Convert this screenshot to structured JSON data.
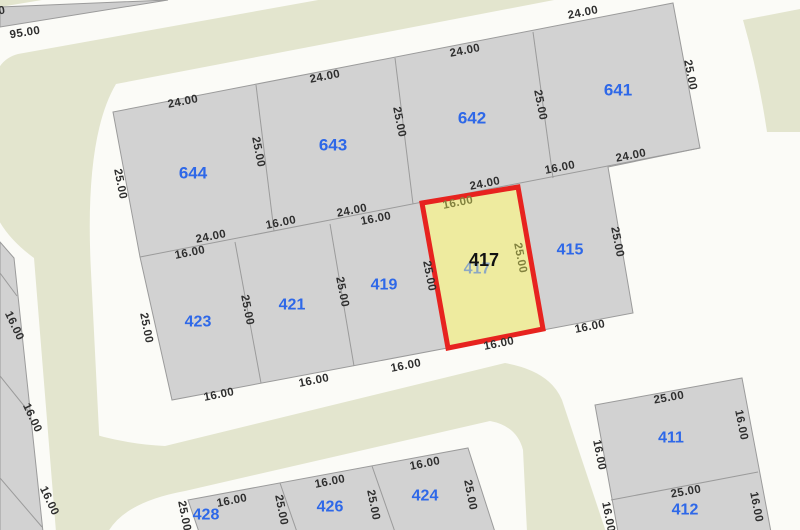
{
  "map": {
    "title": "cadastral-parcel-map",
    "canvas": {
      "width": 800,
      "height": 530
    },
    "colors": {
      "background": "#fbfbf7",
      "road": "#e3e5ce",
      "parcel_fill": "#d2d2d2",
      "wedge_fill": "#cdcdcd",
      "parcel_stroke": "#9b9b9b",
      "highlight_fill": "#eeeb9f",
      "highlight_stroke": "#e7231f",
      "parcel_number_blue": "#2e68e8",
      "dimension_text": "#2f2f2f",
      "dimension_on_highlight": "#82823e"
    },
    "roads": [
      {
        "name": "road-top-and-left",
        "d": "M 585,-48 L 18,54 Q -12,62 -6,108 L -6,210 Q 4,236 34,258 L 56,532 L 104,532 L 91,272 Q 84,138 116,84 L 575,-4 Z"
      },
      {
        "name": "road-bottom-l",
        "d": "M 80,430 Q 122,444 165,446 L 505,363 Q 550,371 562,400 L 606,532 L 527,532 L 523,450 Q 517,426 490,421 L 185,491 Q 125,502 108,532 L 80,532 Z"
      },
      {
        "name": "road-top-right",
        "d": "M 743,20 Q 758,72 767,132 L 800,132 L 800,9 Z"
      },
      {
        "name": "road-top-left-sliver",
        "d": "M 0,0 L 42,0 L 0,7 Z"
      }
    ],
    "blocks": [
      {
        "name": "block-main",
        "points": "113,112 673,3 700,148 608,167 633,313 172,400 140,257"
      },
      {
        "name": "block-south-west",
        "points": "188,500 468,448 495,532 199,532"
      },
      {
        "name": "block-south-east",
        "points": "595,405 742,378 771,532 618,532"
      },
      {
        "name": "block-west-strip",
        "points": "0,242 14,258 43,532 0,532"
      },
      {
        "name": "block-north-west-wedge",
        "points": "0,7 168,0 0,27",
        "wedge": true
      }
    ],
    "boundaries": [
      [
        140,
        257,
        700,
        148
      ],
      [
        256,
        85,
        274,
        231
      ],
      [
        395,
        58,
        413,
        204
      ],
      [
        533,
        32,
        553,
        178
      ],
      [
        235,
        242,
        261,
        383
      ],
      [
        330,
        224,
        354,
        366
      ],
      [
        280,
        483,
        297,
        532
      ],
      [
        372,
        466,
        395,
        532
      ],
      [
        611,
        500,
        758,
        472
      ],
      [
        0,
        273,
        17,
        296
      ],
      [
        0,
        376,
        29,
        412
      ],
      [
        0,
        478,
        42,
        527
      ]
    ],
    "parcels": [
      {
        "id": "644",
        "x": 193,
        "y": 173,
        "big": true
      },
      {
        "id": "643",
        "x": 333,
        "y": 145,
        "big": true
      },
      {
        "id": "642",
        "x": 472,
        "y": 118,
        "big": true
      },
      {
        "id": "641",
        "x": 618,
        "y": 90,
        "big": true
      },
      {
        "id": "423",
        "x": 198,
        "y": 322
      },
      {
        "id": "421",
        "x": 292,
        "y": 305
      },
      {
        "id": "419",
        "x": 384,
        "y": 285
      },
      {
        "id": "415",
        "x": 570,
        "y": 250
      },
      {
        "id": "411",
        "x": 671,
        "y": 438
      },
      {
        "id": "412",
        "x": 685,
        "y": 510
      },
      {
        "id": "424",
        "x": 425,
        "y": 496
      },
      {
        "id": "426",
        "x": 330,
        "y": 507
      },
      {
        "id": "428",
        "x": 206,
        "y": 515
      }
    ],
    "selected_parcel": {
      "id": "417",
      "points": "422,203 518,187 543,329 448,348",
      "label": {
        "x": 484,
        "y": 260
      },
      "ghost": {
        "x": 477,
        "y": 269
      }
    },
    "dimensions": [
      {
        "t": "24.00",
        "x": 183,
        "y": 102,
        "r": -11
      },
      {
        "t": "24.00",
        "x": 325,
        "y": 77,
        "r": -11
      },
      {
        "t": "24.00",
        "x": 465,
        "y": 51,
        "r": -11
      },
      {
        "t": "24.00",
        "x": 583,
        "y": 13,
        "r": -11
      },
      {
        "t": "25.00",
        "x": 120,
        "y": 184,
        "r": 79
      },
      {
        "t": "25.00",
        "x": 258,
        "y": 152,
        "r": 79
      },
      {
        "t": "25.00",
        "x": 399,
        "y": 122,
        "r": 79
      },
      {
        "t": "25.00",
        "x": 540,
        "y": 105,
        "r": 79
      },
      {
        "t": "25.00",
        "x": 690,
        "y": 75,
        "r": 79
      },
      {
        "t": "24.00",
        "x": 211,
        "y": 237,
        "r": -11
      },
      {
        "t": "16.00",
        "x": 190,
        "y": 253,
        "r": -11
      },
      {
        "t": "16.00",
        "x": 281,
        "y": 223,
        "r": -11
      },
      {
        "t": "24.00",
        "x": 352,
        "y": 211,
        "r": -11
      },
      {
        "t": "16.00",
        "x": 376,
        "y": 219,
        "r": -11
      },
      {
        "t": "24.00",
        "x": 485,
        "y": 184,
        "r": -11
      },
      {
        "t": "16.00",
        "x": 458,
        "y": 203,
        "r": -11,
        "olive": true
      },
      {
        "t": "16.00",
        "x": 560,
        "y": 168,
        "r": -11
      },
      {
        "t": "24.00",
        "x": 631,
        "y": 156,
        "r": -11
      },
      {
        "t": "25.00",
        "x": 146,
        "y": 328,
        "r": 79
      },
      {
        "t": "25.00",
        "x": 247,
        "y": 310,
        "r": 79
      },
      {
        "t": "25.00",
        "x": 342,
        "y": 292,
        "r": 79
      },
      {
        "t": "25.00",
        "x": 429,
        "y": 276,
        "r": 79
      },
      {
        "t": "25.00",
        "x": 520,
        "y": 258,
        "r": 79,
        "olive": true
      },
      {
        "t": "25.00",
        "x": 617,
        "y": 242,
        "r": 79
      },
      {
        "t": "16.00",
        "x": 219,
        "y": 395,
        "r": -11
      },
      {
        "t": "16.00",
        "x": 314,
        "y": 381,
        "r": -11
      },
      {
        "t": "16.00",
        "x": 406,
        "y": 366,
        "r": -11
      },
      {
        "t": "16.00",
        "x": 499,
        "y": 344,
        "r": -11
      },
      {
        "t": "16.00",
        "x": 590,
        "y": 327,
        "r": -11
      },
      {
        "t": "16.00",
        "x": 14,
        "y": 326,
        "r": 65
      },
      {
        "t": "16.00",
        "x": 32,
        "y": 418,
        "r": 65
      },
      {
        "t": "16.00",
        "x": 49,
        "y": 501,
        "r": 65
      },
      {
        "t": "16.00",
        "x": 232,
        "y": 501,
        "r": -11
      },
      {
        "t": "16.00",
        "x": 330,
        "y": 482,
        "r": -11
      },
      {
        "t": "16.00",
        "x": 425,
        "y": 464,
        "r": -11
      },
      {
        "t": "25.00",
        "x": 184,
        "y": 516,
        "r": 79
      },
      {
        "t": "25.00",
        "x": 281,
        "y": 510,
        "r": 79
      },
      {
        "t": "25.00",
        "x": 373,
        "y": 505,
        "r": 79
      },
      {
        "t": "25.00",
        "x": 470,
        "y": 495,
        "r": 79
      },
      {
        "t": "25.00",
        "x": 669,
        "y": 398,
        "r": -10
      },
      {
        "t": "16.00",
        "x": 599,
        "y": 455,
        "r": 79
      },
      {
        "t": "16.00",
        "x": 741,
        "y": 425,
        "r": 79
      },
      {
        "t": "25.00",
        "x": 686,
        "y": 492,
        "r": -10
      },
      {
        "t": "16.00",
        "x": 608,
        "y": 517,
        "r": 79
      },
      {
        "t": "16.00",
        "x": 756,
        "y": 507,
        "r": 79
      },
      {
        "t": "95.00",
        "x": 25,
        "y": 33,
        "r": -9
      },
      {
        "t": "0",
        "x": 2,
        "y": 11,
        "r": -10
      }
    ]
  }
}
